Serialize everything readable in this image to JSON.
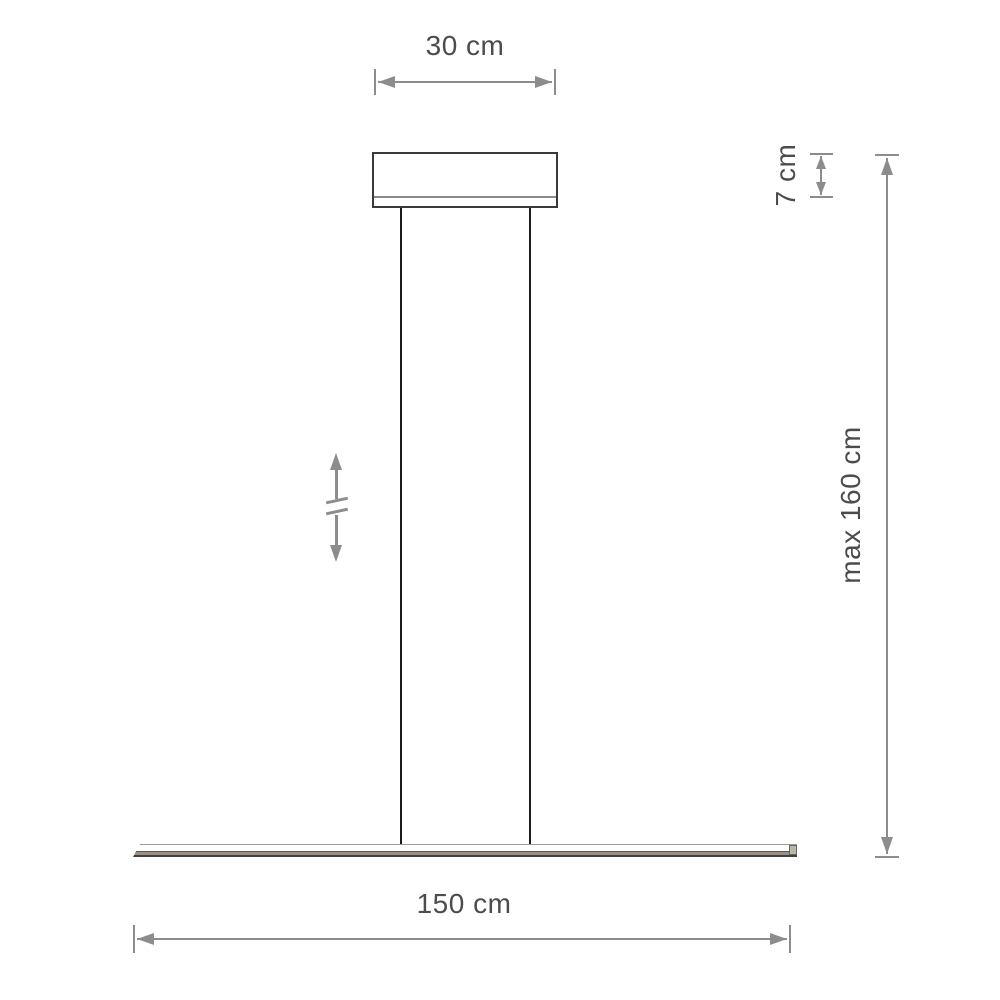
{
  "diagram": {
    "type": "product dimension drawing",
    "subject": "linear pendant lamp side view",
    "dimensions": {
      "canopy_width": {
        "label": "30 cm",
        "orientation": "horizontal"
      },
      "canopy_height": {
        "label": "7 cm",
        "orientation": "vertical"
      },
      "max_suspension_height": {
        "label": "max 160 cm",
        "orientation": "vertical"
      },
      "fixture_length": {
        "label": "150 cm",
        "orientation": "horizontal"
      }
    },
    "icons": [
      {
        "name": "height-adjustable-icon",
        "meaning": "adjustable suspension height double arrow with break marks"
      }
    ],
    "colors": {
      "background": "#ffffff",
      "dimension_lines": "#8c8c8c",
      "label_text": "#4c4c4c",
      "canopy_outline": "#3a3a3a",
      "wire": "#1c1c1c",
      "bar_edge_bronze": "#9a9086"
    }
  }
}
